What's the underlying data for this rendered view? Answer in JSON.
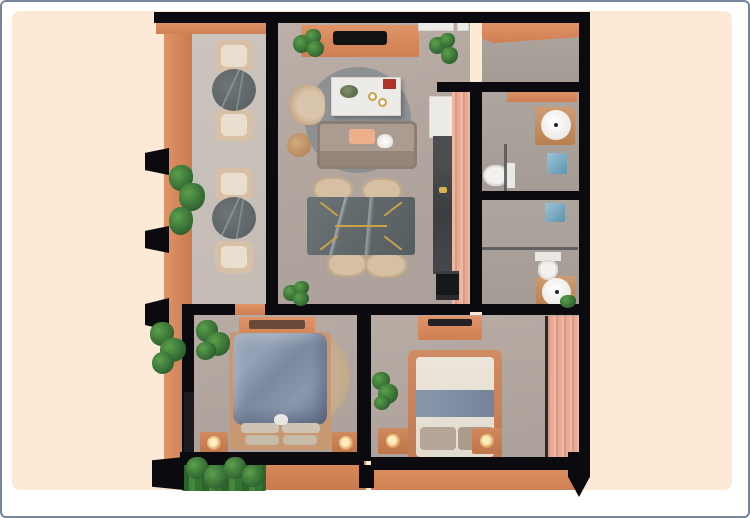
{
  "scene": {
    "description": "top-down 3d rendered apartment floor plan on cream card",
    "visible_text": "",
    "background_color": "#fcead7",
    "page_color": "#ffffff",
    "border_color": "#74859c"
  },
  "palette": {
    "wall_black": "#0b0b0f",
    "terracotta": "#d98a5e",
    "terracotta_dark": "#c07248",
    "pink_slat_wood": "#ecb19d",
    "shower_deck_wood": "#cb9180",
    "concrete_floor": "#b2a69f",
    "balcony_floor": "#c8c1ba",
    "dark_marble": "#62696d",
    "gold_inlay": "#c9a24a",
    "sofa_taupe": "#a2938a",
    "duvet_blue_gray": "#8291a8",
    "bed2_cream": "#e7e1d6",
    "jute_rug": "#c1aa89",
    "living_rug_gray": "#8f9395",
    "plant_green": "#3c7c36",
    "peach_pillow": "#edb08b",
    "counter_dark": "#3f4446",
    "white_fixture": "#f2f1ee"
  },
  "rooms": [
    {
      "id": "balcony-left",
      "label": "side terrace",
      "furniture": [
        "2 bistro seating groups",
        "round dark marble tables",
        "wicker chairs",
        "planters",
        "sun fins"
      ]
    },
    {
      "id": "living-dining",
      "label": "living and dining room",
      "furniture": [
        "tv console",
        "tv",
        "wall shelves",
        "round gray rug",
        "white coffee island",
        "wicker armchair",
        "round side table",
        "sofa with peach pillow and white cat",
        "dark marble dining table with gold inlay",
        "4 dining chairs",
        "corner plants"
      ]
    },
    {
      "id": "kitchen",
      "label": "galley kitchen",
      "furniture": [
        "fridge cabinet",
        "dark stone counter",
        "oven",
        "pink slat partition"
      ]
    },
    {
      "id": "entry",
      "label": "entry hall",
      "furniture": [
        "terracotta console"
      ]
    },
    {
      "id": "bathroom-1",
      "label": "bathroom 1",
      "furniture": [
        "round basin on wood vanity",
        "wood shower deck",
        "toilet",
        "terracotta shelf"
      ]
    },
    {
      "id": "bathroom-2",
      "label": "bathroom 2",
      "furniture": [
        "wood shower deck",
        "toilet",
        "round basin on wood vanity",
        "small plant"
      ]
    },
    {
      "id": "bedroom-1",
      "label": "bedroom 1",
      "furniture": [
        "double bed with gray-blue duvet and white cat logo",
        "round jute rug",
        "2 nightstands with lamps",
        "dresser",
        "plants",
        "side window"
      ]
    },
    {
      "id": "bedroom-2",
      "label": "bedroom 2",
      "furniture": [
        "double bed cream with blue-gray runner",
        "2 nightstands with lamps",
        "tv console",
        "pink slat wardrobe",
        "plant"
      ]
    },
    {
      "id": "rear-balcony",
      "label": "rear balcony",
      "furniture": [
        "green hedge planter",
        "terracotta deck",
        "sliding door track"
      ]
    }
  ]
}
